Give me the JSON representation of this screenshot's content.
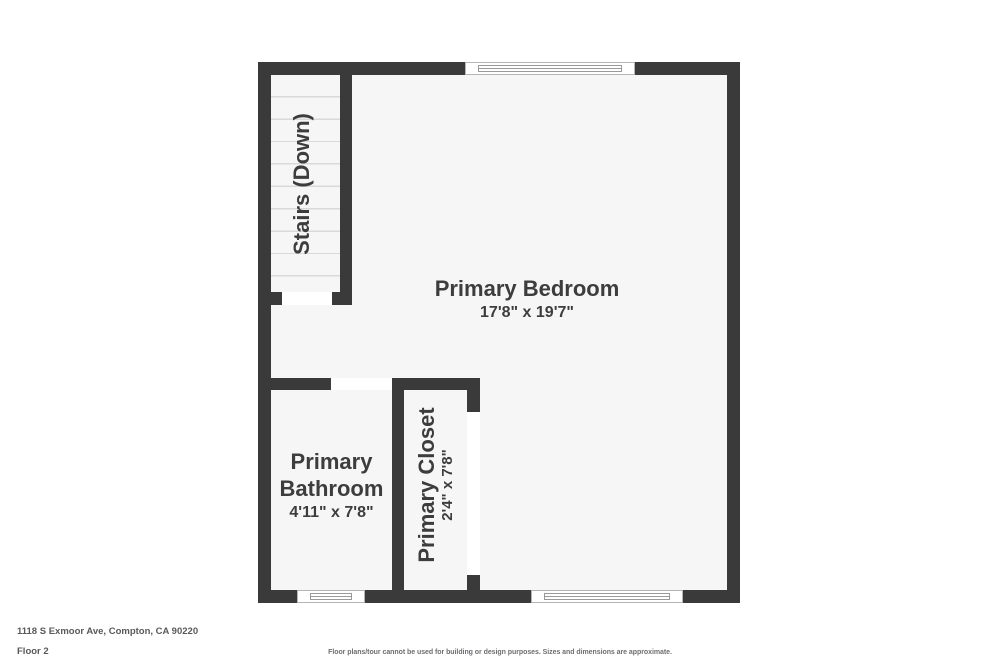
{
  "colors": {
    "wall": "#3a3a3a",
    "floor": "#f6f6f6",
    "background": "#ffffff",
    "text": "#3d3d3d",
    "muted_text": "#58595b",
    "step_line": "#d9d9d9",
    "window_frame": "#9a9a9a"
  },
  "rooms": {
    "bedroom": {
      "name": "Primary Bedroom",
      "dimensions": "17'8\" x 19'7\""
    },
    "bathroom": {
      "name": "Primary Bathroom",
      "dimensions": "4'11\" x 7'8\""
    },
    "closet": {
      "name": "Primary Closet",
      "dimensions": "2'4\" x 7'8\""
    },
    "stairs": {
      "name": "Stairs (Down)"
    }
  },
  "footer": {
    "address": "1118 S Exmoor Ave, Compton, CA 90220",
    "floor_label": "Floor 2",
    "disclaimer": "Floor plans/tour cannot be used for building or design purposes. Sizes and dimensions are approximate."
  }
}
